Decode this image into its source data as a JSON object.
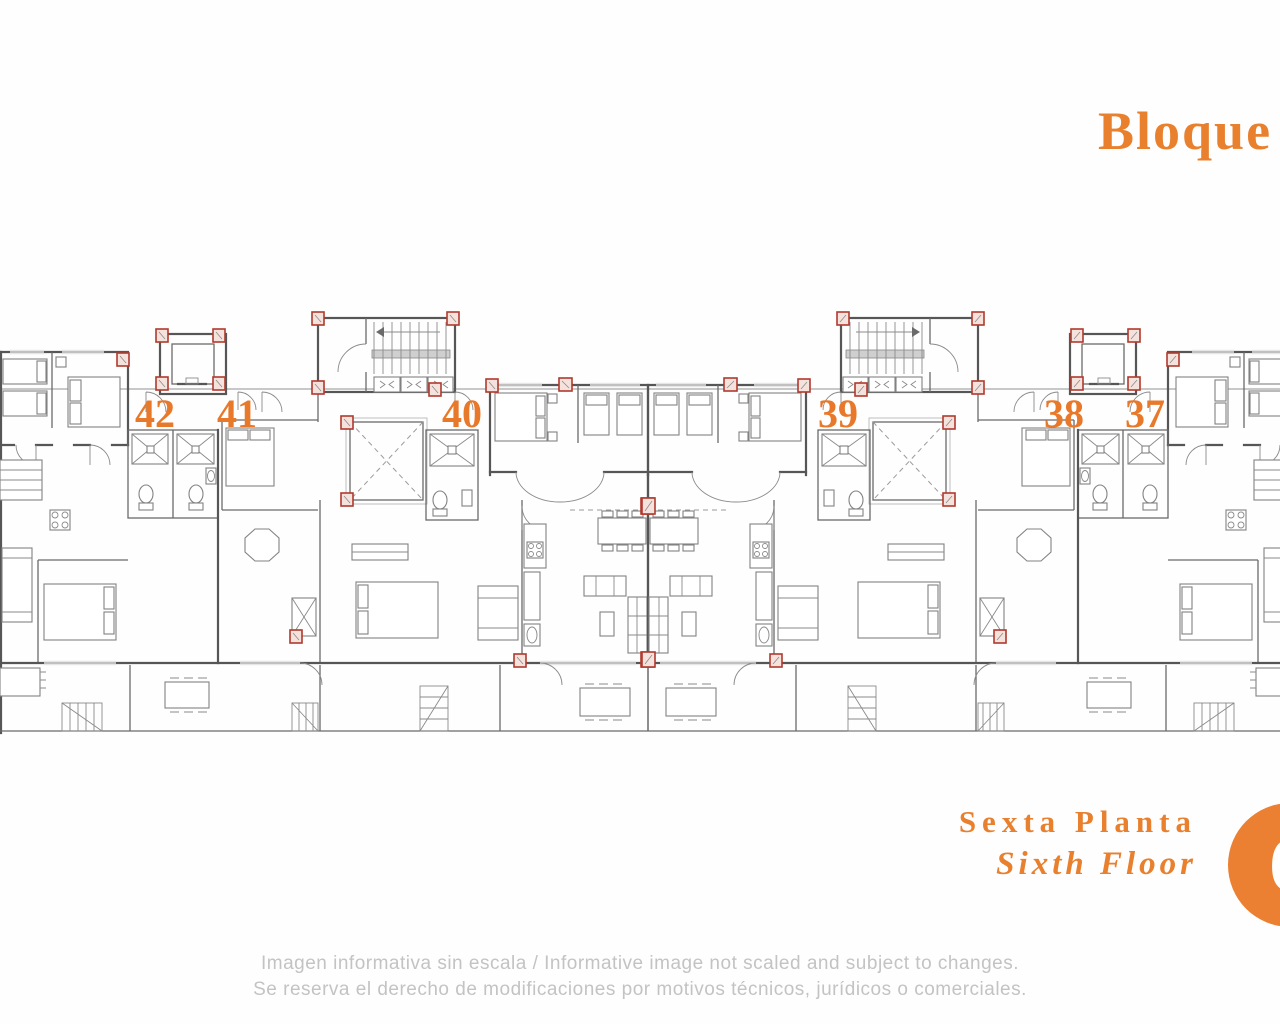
{
  "title": {
    "text": "Bloque"
  },
  "plan": {
    "apartments": [
      {
        "number": "42"
      },
      {
        "number": "41"
      },
      {
        "number": "40"
      },
      {
        "number": "39"
      },
      {
        "number": "38"
      },
      {
        "number": "37"
      }
    ],
    "floor_badge": "6"
  },
  "floor_label": {
    "spanish": "Sexta Planta",
    "english": "Sixth Floor"
  },
  "disclaimer": {
    "line1": "Imagen informativa sin escala /  Informative image not scaled and subject to changes.",
    "line2": "Se reserva el derecho de modificaciones por motivos técnicos, jurídicos o comerciales."
  },
  "colors": {
    "accent_orange": "#E8802E",
    "number_orange": "#E8792A",
    "badge_orange": "#EC8032",
    "wall_gray": "#565656",
    "column_red": "#B03A2E",
    "disclaimer_gray": "#C3C3C3"
  }
}
